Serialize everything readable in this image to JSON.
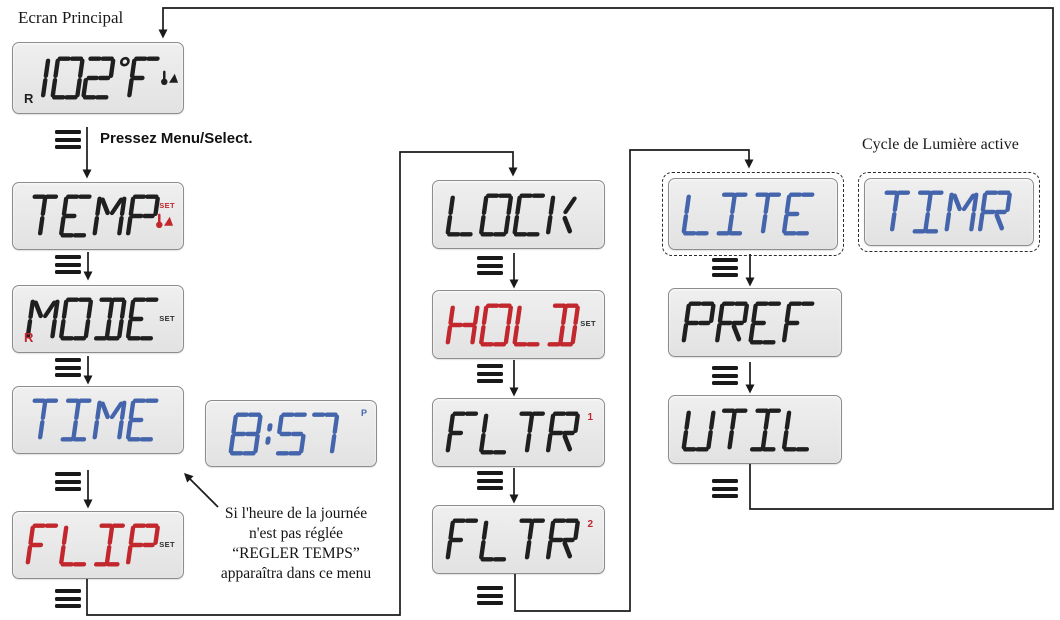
{
  "labels": {
    "main_screen": "Ecran Principal",
    "press_menu": "Pressez Menu/Select.",
    "light_cycle_active": "Cycle de Lumière active",
    "time_note_lines": [
      "Si l'heure de la journée",
      "n'est pas réglée",
      "“REGLER TEMPS”",
      "apparaîtra dans ce menu"
    ]
  },
  "colors": {
    "seg_black": "#1f1f1f",
    "seg_blue": "#4465ab",
    "seg_red": "#c1272d",
    "ind_dark": "#2e2e2e",
    "lcd_bg": "#e8e8e8",
    "lcd_border": "#8d8d8d"
  },
  "screens": [
    {
      "id": "main",
      "display": "102°F",
      "color_key": "seg_black",
      "indicators": [
        {
          "type": "text",
          "label": "R",
          "pos": "bl",
          "color_key": "seg_black",
          "name": "range-indicator-r"
        },
        {
          "type": "therm",
          "pos": "right",
          "color_key": "seg_black",
          "name": "heat-thermometer-icon"
        }
      ]
    },
    {
      "id": "temp",
      "display": "TEMP",
      "color_key": "seg_black",
      "indicators": [
        {
          "type": "text",
          "label": "SET",
          "pos": "set-tr",
          "color_key": "seg_red",
          "name": "set-indicator"
        },
        {
          "type": "therm",
          "pos": "under-set",
          "color_key": "seg_red",
          "name": "heat-thermometer-icon"
        }
      ]
    },
    {
      "id": "mode",
      "display": "MODE",
      "color_key": "seg_black",
      "indicators": [
        {
          "type": "text",
          "label": "SET",
          "pos": "set-r",
          "color_key": "ind_dark",
          "name": "set-indicator"
        },
        {
          "type": "text",
          "label": "R",
          "pos": "bl",
          "color_key": "seg_red",
          "name": "range-indicator-r"
        }
      ]
    },
    {
      "id": "time",
      "display": "TIME",
      "color_key": "seg_blue",
      "indicators": []
    },
    {
      "id": "clock",
      "display": "8:57",
      "color_key": "seg_blue",
      "indicators": [
        {
          "type": "text",
          "label": "P",
          "pos": "p-tr",
          "color_key": "seg_blue",
          "name": "pm-indicator"
        }
      ]
    },
    {
      "id": "flip",
      "display": "FLIP",
      "color_key": "seg_red",
      "indicators": [
        {
          "type": "text",
          "label": "SET",
          "pos": "set-r",
          "color_key": "ind_dark",
          "name": "set-indicator"
        }
      ]
    },
    {
      "id": "lock",
      "display": "LOCK",
      "color_key": "seg_black",
      "indicators": []
    },
    {
      "id": "hold",
      "display": "HOLD",
      "color_key": "seg_red",
      "indicators": [
        {
          "type": "text",
          "label": "SET",
          "pos": "set-r",
          "color_key": "ind_dark",
          "name": "set-indicator"
        }
      ]
    },
    {
      "id": "fltr1",
      "display": "FLTR",
      "color_key": "seg_black",
      "indicators": [
        {
          "type": "text",
          "label": "1",
          "pos": "num-tr",
          "color_key": "seg_red",
          "name": "filter-1-indicator"
        }
      ]
    },
    {
      "id": "fltr2",
      "display": "FLTR",
      "color_key": "seg_black",
      "indicators": [
        {
          "type": "text",
          "label": "2",
          "pos": "num-tr",
          "color_key": "seg_red",
          "name": "filter-2-indicator"
        }
      ]
    },
    {
      "id": "lite",
      "display": "LITE",
      "color_key": "seg_blue",
      "indicators": []
    },
    {
      "id": "timr",
      "display": "TIMR",
      "color_key": "seg_blue",
      "indicators": []
    },
    {
      "id": "pref",
      "display": "PREF",
      "color_key": "seg_black",
      "indicators": []
    },
    {
      "id": "util",
      "display": "UTIL",
      "color_key": "seg_black",
      "indicators": []
    }
  ]
}
